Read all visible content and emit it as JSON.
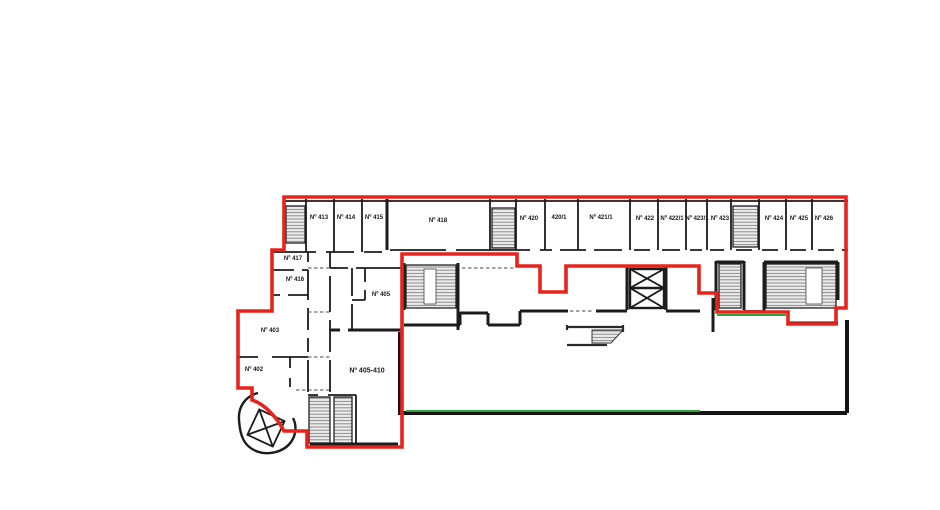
{
  "plan": {
    "rooms": {
      "r413": "Nº 413",
      "r414": "Nº 414",
      "r415": "Nº 415",
      "r418": "Nº 418",
      "r420": "Nº 420",
      "r420_1": "420/1",
      "r421_1": "Nº 421/1",
      "r422": "Nº 422",
      "r422_1": "Nº 422/1",
      "r423_1": "Nº 423/1",
      "r423": "Nº 423",
      "r424": "Nº 424",
      "r425": "Nº 425",
      "r426": "Nº 426",
      "r417": "Nº 417",
      "r416": "Nº 416",
      "r405": "Nº 405",
      "r403": "Nº 403",
      "r402": "Nº 402",
      "r405_410": "Nº 405-410"
    },
    "colors": {
      "boundary_red": "#e8231c",
      "accent_green": "#2ca33c",
      "wall_black": "#1c1c1c",
      "hatch_gray": "#8a8a8a"
    }
  }
}
